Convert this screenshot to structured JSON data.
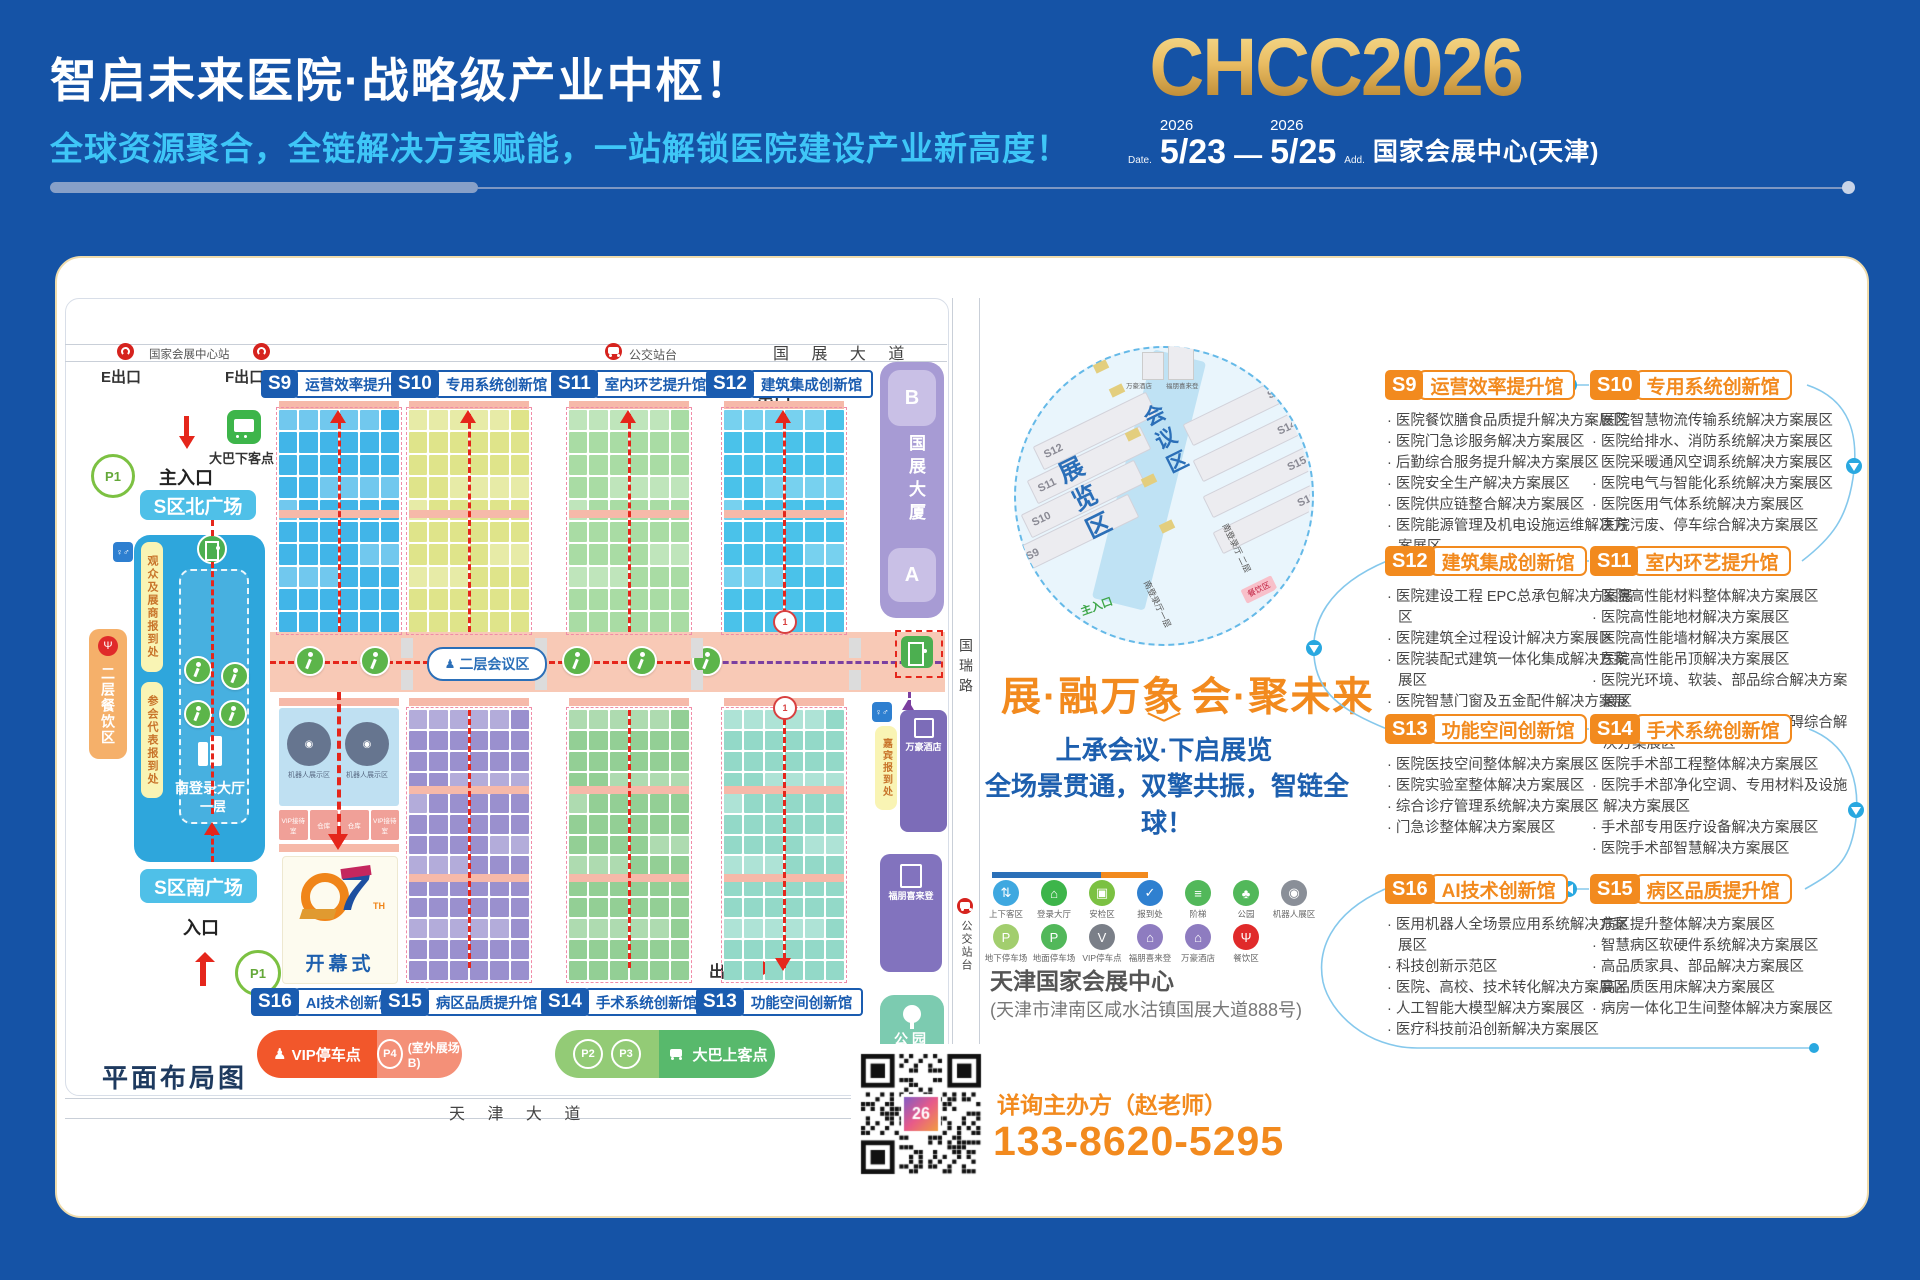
{
  "header": {
    "title": "智启未来医院·战略级产业中枢！",
    "subtitle": "全球资源聚合，全链解决方案赋能，一站解锁医院建设产业新高度！",
    "logo": "CHCC2026",
    "date_label": "Date.",
    "year1": "2026",
    "date_start": "5/23",
    "dash": "—",
    "year2": "2026",
    "date_end": "5/25",
    "addr_label": "Add.",
    "venue": "国家会展中心(天津)"
  },
  "map": {
    "plan_title": "平面布局图",
    "roads": {
      "top": "国 展 大 道",
      "bottom": "天 津 大 道",
      "right": "国瑞路"
    },
    "transit": {
      "station": "国家会展中心站",
      "bus_stop_top": "公交站台",
      "bus_stop_right": "公交站台",
      "exit_e": "E出口",
      "exit_f": "F出口"
    },
    "halls_top": [
      {
        "code": "S9",
        "name": "运营效率提升馆",
        "color": "#41B5E8"
      },
      {
        "code": "S10",
        "name": "专用系统创新馆",
        "color": "#DFE48A"
      },
      {
        "code": "S11",
        "name": "室内环艺提升馆",
        "color": "#A9DCA4"
      },
      {
        "code": "S12",
        "name": "建筑集成创新馆",
        "color": "#4AC2EA"
      }
    ],
    "halls_bottom": [
      {
        "code": "S16",
        "name": "AI技术创新馆",
        "color": "#A9D7EF"
      },
      {
        "code": "S15",
        "name": "病区品质提升馆",
        "color": "#9A90CE"
      },
      {
        "code": "S14",
        "name": "手术系统创新馆",
        "color": "#93CF95"
      },
      {
        "code": "S13",
        "name": "功能空间创新馆",
        "color": "#93D9C8"
      }
    ],
    "signs": {
      "exit_top": "出口",
      "exit_bottom": "出口",
      "main_entrance": "主入口",
      "entrance": "入口",
      "north_plaza": "S区北广场",
      "south_plaza": "S区南广场",
      "conference": "二层会议区"
    },
    "south_hall": {
      "name": "南登录大厅",
      "floor": "一层",
      "visitor": "观众及展商报到处",
      "delegate": "参会代表报到处"
    },
    "dining_left": "二层餐饮区",
    "bus_drop": "大巴下客点",
    "parking": {
      "p1": "P1",
      "p2": "P2",
      "p3": "P3",
      "p4": "P4",
      "vip": "VIP停车点",
      "outdoor": "(室外展场B)",
      "bus_pick": "大巴上客点"
    },
    "tower": {
      "name": "国展大厦",
      "b": "B",
      "a": "A"
    },
    "right_side": {
      "guest": "嘉宾报到处",
      "marriott": "万豪酒店",
      "sheraton": "福朋喜来登",
      "park": "公园"
    },
    "opening": {
      "number": "27",
      "suffix": "TH",
      "label": "开幕式"
    },
    "robot_zone": "机器人展示区",
    "vip_cells": [
      "VIP接待室",
      "仓库",
      "仓库",
      "VIP接待室"
    ]
  },
  "overview": {
    "exhibition": "展览区",
    "conference": "会议区",
    "left_halls": [
      "S12",
      "S11",
      "S10",
      "S9"
    ],
    "right_halls": [
      "S13",
      "S14",
      "S15",
      "S16"
    ],
    "entrance": "主入口",
    "hall_f1": "南登录厅一层",
    "hall_f2": "南登录厅 二层",
    "dining": "餐饮区",
    "marriott": "万豪酒店",
    "sheraton": "福朋喜来登"
  },
  "slogan": {
    "headline_left": "展·融万象",
    "headline_right": "会·聚未来",
    "line1": "上承会议·下启展览",
    "line2": "全场景贯通，双擎共振，智链全球！"
  },
  "legend": {
    "rows": [
      [
        {
          "name": "passenger-zone-icon",
          "glyph": "⇅",
          "color": "#3FA8E0",
          "label": "上下客区"
        },
        {
          "name": "login-hall-icon",
          "glyph": "⌂",
          "color": "#3DB54A",
          "label": "登录大厅"
        },
        {
          "name": "security-check-icon",
          "glyph": "▣",
          "color": "#7BC142",
          "label": "安检区"
        },
        {
          "name": "checkin-icon",
          "glyph": "✓",
          "color": "#2F80D0",
          "label": "报到处"
        },
        {
          "name": "stairs-icon",
          "glyph": "≡",
          "color": "#52B85A",
          "label": "阶梯"
        },
        {
          "name": "park-icon",
          "glyph": "♣",
          "color": "#52B85A",
          "label": "公园"
        },
        {
          "name": "robot-zone-icon",
          "glyph": "◉",
          "color": "#8A8F98",
          "label": "机器人展区"
        }
      ],
      [
        {
          "name": "underground-parking-icon",
          "glyph": "P",
          "color": "#A2CE6E",
          "label": "地下停车场"
        },
        {
          "name": "ground-parking-icon",
          "glyph": "P",
          "color": "#52B85A",
          "label": "地面停车场"
        },
        {
          "name": "vip-parking-icon",
          "glyph": "V",
          "color": "#7A7F88",
          "label": "VIP停车点"
        },
        {
          "name": "sheraton-icon",
          "glyph": "⌂",
          "color": "#8E7CC0",
          "label": "福朋喜来登"
        },
        {
          "name": "marriott-icon",
          "glyph": "⌂",
          "color": "#8E7CC0",
          "label": "万豪酒店"
        },
        {
          "name": "dining-icon",
          "glyph": "Ψ",
          "color": "#E02A2A",
          "label": "餐饮区"
        }
      ]
    ]
  },
  "address": {
    "name": "天津国家会展中心",
    "detail": "(天津市津南区咸水沽镇国展大道888号)"
  },
  "contact": {
    "label": "详询主办方（赵老师）",
    "phone": "133-8620-5295",
    "qr_logo": "26"
  },
  "sections": [
    {
      "code": "S9",
      "name": "运营效率提升馆",
      "row": 0,
      "col": 0,
      "bullets": [
        "医院餐饮膳食品质提升解决方案展区",
        "医院门急诊服务解决方案展区",
        "后勤综合服务提升解决方案展区",
        "医院安全生产解决方案展区",
        "医院供应链整合解决方案展区",
        "医院能源管理及机电设施运维解决方案展区"
      ]
    },
    {
      "code": "S10",
      "name": "专用系统创新馆",
      "row": 0,
      "col": 1,
      "bullets": [
        "医院智慧物流传输系统解决方案展区",
        "医院给排水、消防系统解决方案展区",
        "医院采暖通风空调系统解决方案展区",
        "医院电气与智能化系统解决方案展区",
        "医院医用气体系统解决方案展区",
        "医院污废、停车综合解决方案展区"
      ]
    },
    {
      "code": "S12",
      "name": "建筑集成创新馆",
      "row": 1,
      "col": 0,
      "bullets": [
        "医院建设工程 EPC总承包解决方案展区",
        "医院建筑全过程设计解决方案展区",
        "医院装配式建筑一体化集成解决方案展区",
        "医院智慧门窗及五金配件解决方案展区"
      ]
    },
    {
      "code": "S11",
      "name": "室内环艺提升馆",
      "row": 1,
      "col": 1,
      "bullets": [
        "医院高性能材料整体解决方案展区",
        "医院高性能地材解决方案展区",
        "医院高性能墙材解决方案展区",
        "医院高性能吊顶解决方案展区",
        "医院光环境、软装、部品综合解决方案展区",
        "医院艺术品、标识标牌、无障碍综合解决方案展区"
      ]
    },
    {
      "code": "S13",
      "name": "功能空间创新馆",
      "row": 2,
      "col": 0,
      "bullets": [
        "医院医技空间整体解决方案展区",
        "医院实验室整体解决方案展区",
        "综合诊疗管理系统解决方案展区",
        "门急诊整体解决方案展区"
      ]
    },
    {
      "code": "S14",
      "name": "手术系统创新馆",
      "row": 2,
      "col": 1,
      "bullets": [
        "医院手术部工程整体解决方案展区",
        "医院手术部净化空调、专用材料及设施解决方案展区",
        "手术部专用医疗设备解决方案展区",
        "医院手术部智慧解决方案展区"
      ]
    },
    {
      "code": "S16",
      "name": "AI技术创新馆",
      "row": 3,
      "col": 0,
      "bullets": [
        "医用机器人全场景应用系统解决方案展区",
        "科技创新示范区",
        "医院、高校、技术转化解决方案展区",
        "人工智能大模型解决方案展区",
        "医疗科技前沿创新解决方案展区"
      ]
    },
    {
      "code": "S15",
      "name": "病区品质提升馆",
      "row": 3,
      "col": 1,
      "bullets": [
        "病区提升整体解决方案展区",
        "智慧病区软硬件系统解决方案展区",
        "高品质家具、部品解决方案展区",
        "高品质医用床解决方案展区",
        "病房一体化卫生间整体解决方案展区"
      ]
    }
  ]
}
